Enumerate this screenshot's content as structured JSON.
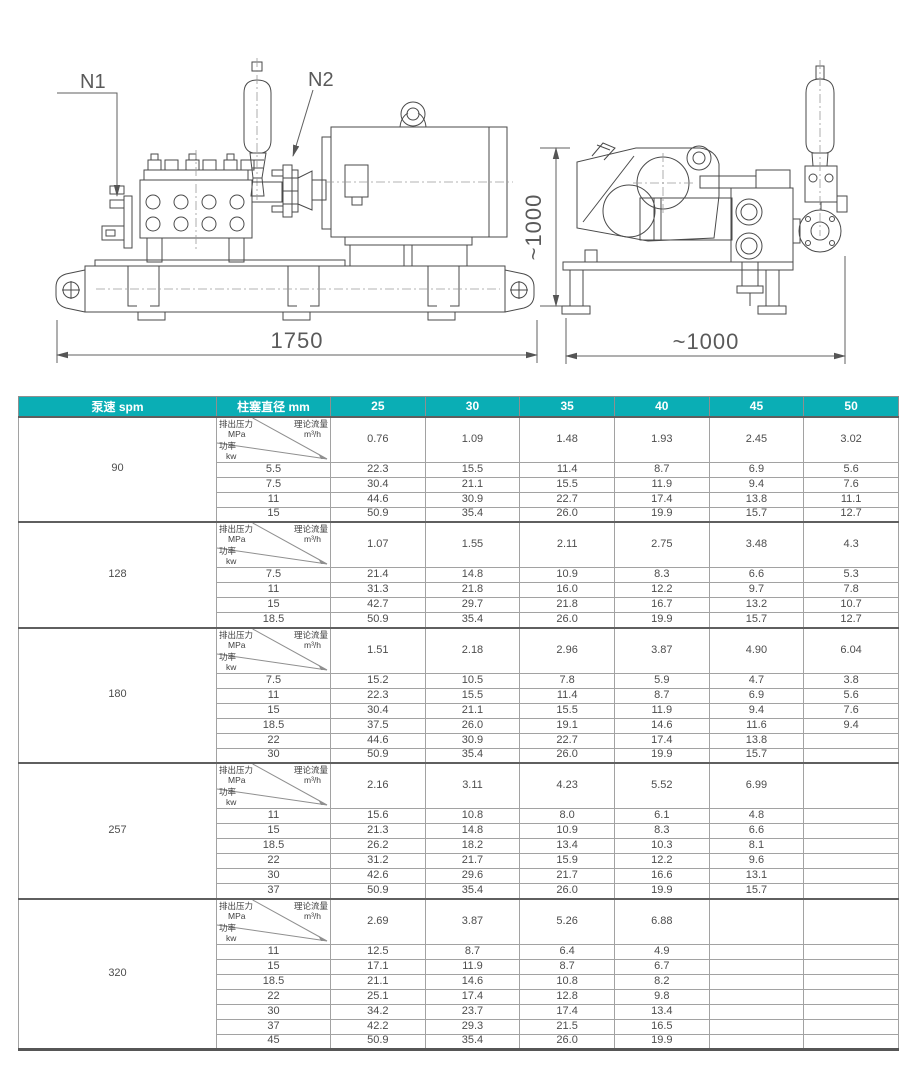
{
  "drawing": {
    "labels": {
      "n1": "N1",
      "n2": "N2",
      "dim_length": "1750",
      "dim_height": "~1000",
      "dim_width": "~1000"
    },
    "line_color": "#4a4a4a",
    "dim_color": "#5a5a5a"
  },
  "table": {
    "accent_color": "#0aaeb5",
    "header": {
      "speed": "泵速  spm",
      "diameter": "柱塞直径 mm"
    },
    "diameters": [
      "25",
      "30",
      "35",
      "40",
      "45",
      "50"
    ],
    "diag": {
      "pressure": "排出压力",
      "pressure_unit": "MPa",
      "flow": "理论流量",
      "flow_unit": "m³/h",
      "power": "功率",
      "power_unit": "kw"
    },
    "sections": [
      {
        "speed": "90",
        "flow": [
          "0.76",
          "1.09",
          "1.48",
          "1.93",
          "2.45",
          "3.02"
        ],
        "rows": [
          {
            "power": "5.5",
            "values": [
              "22.3",
              "15.5",
              "11.4",
              "8.7",
              "6.9",
              "5.6"
            ]
          },
          {
            "power": "7.5",
            "values": [
              "30.4",
              "21.1",
              "15.5",
              "11.9",
              "9.4",
              "7.6"
            ]
          },
          {
            "power": "11",
            "values": [
              "44.6",
              "30.9",
              "22.7",
              "17.4",
              "13.8",
              "11.1"
            ]
          },
          {
            "power": "15",
            "values": [
              "50.9",
              "35.4",
              "26.0",
              "19.9",
              "15.7",
              "12.7"
            ]
          }
        ]
      },
      {
        "speed": "128",
        "flow": [
          "1.07",
          "1.55",
          "2.11",
          "2.75",
          "3.48",
          "4.3"
        ],
        "rows": [
          {
            "power": "7.5",
            "values": [
              "21.4",
              "14.8",
              "10.9",
              "8.3",
              "6.6",
              "5.3"
            ]
          },
          {
            "power": "11",
            "values": [
              "31.3",
              "21.8",
              "16.0",
              "12.2",
              "9.7",
              "7.8"
            ]
          },
          {
            "power": "15",
            "values": [
              "42.7",
              "29.7",
              "21.8",
              "16.7",
              "13.2",
              "10.7"
            ]
          },
          {
            "power": "18.5",
            "values": [
              "50.9",
              "35.4",
              "26.0",
              "19.9",
              "15.7",
              "12.7"
            ]
          }
        ]
      },
      {
        "speed": "180",
        "flow": [
          "1.51",
          "2.18",
          "2.96",
          "3.87",
          "4.90",
          "6.04"
        ],
        "rows": [
          {
            "power": "7.5",
            "values": [
              "15.2",
              "10.5",
              "7.8",
              "5.9",
              "4.7",
              "3.8"
            ]
          },
          {
            "power": "11",
            "values": [
              "22.3",
              "15.5",
              "11.4",
              "8.7",
              "6.9",
              "5.6"
            ]
          },
          {
            "power": "15",
            "values": [
              "30.4",
              "21.1",
              "15.5",
              "11.9",
              "9.4",
              "7.6"
            ]
          },
          {
            "power": "18.5",
            "values": [
              "37.5",
              "26.0",
              "19.1",
              "14.6",
              "11.6",
              "9.4"
            ]
          },
          {
            "power": "22",
            "values": [
              "44.6",
              "30.9",
              "22.7",
              "17.4",
              "13.8",
              ""
            ]
          },
          {
            "power": "30",
            "values": [
              "50.9",
              "35.4",
              "26.0",
              "19.9",
              "15.7",
              ""
            ]
          }
        ]
      },
      {
        "speed": "257",
        "flow": [
          "2.16",
          "3.11",
          "4.23",
          "5.52",
          "6.99",
          ""
        ],
        "rows": [
          {
            "power": "11",
            "values": [
              "15.6",
              "10.8",
              "8.0",
              "6.1",
              "4.8",
              ""
            ]
          },
          {
            "power": "15",
            "values": [
              "21.3",
              "14.8",
              "10.9",
              "8.3",
              "6.6",
              ""
            ]
          },
          {
            "power": "18.5",
            "values": [
              "26.2",
              "18.2",
              "13.4",
              "10.3",
              "8.1",
              ""
            ]
          },
          {
            "power": "22",
            "values": [
              "31.2",
              "21.7",
              "15.9",
              "12.2",
              "9.6",
              ""
            ]
          },
          {
            "power": "30",
            "values": [
              "42.6",
              "29.6",
              "21.7",
              "16.6",
              "13.1",
              ""
            ]
          },
          {
            "power": "37",
            "values": [
              "50.9",
              "35.4",
              "26.0",
              "19.9",
              "15.7",
              ""
            ]
          }
        ]
      },
      {
        "speed": "320",
        "flow": [
          "2.69",
          "3.87",
          "5.26",
          "6.88",
          "",
          ""
        ],
        "rows": [
          {
            "power": "11",
            "values": [
              "12.5",
              "8.7",
              "6.4",
              "4.9",
              "",
              ""
            ]
          },
          {
            "power": "15",
            "values": [
              "17.1",
              "11.9",
              "8.7",
              "6.7",
              "",
              ""
            ]
          },
          {
            "power": "18.5",
            "values": [
              "21.1",
              "14.6",
              "10.8",
              "8.2",
              "",
              ""
            ]
          },
          {
            "power": "22",
            "values": [
              "25.1",
              "17.4",
              "12.8",
              "9.8",
              "",
              ""
            ]
          },
          {
            "power": "30",
            "values": [
              "34.2",
              "23.7",
              "17.4",
              "13.4",
              "",
              ""
            ]
          },
          {
            "power": "37",
            "values": [
              "42.2",
              "29.3",
              "21.5",
              "16.5",
              "",
              ""
            ]
          },
          {
            "power": "45",
            "values": [
              "50.9",
              "35.4",
              "26.0",
              "19.9",
              "",
              ""
            ]
          }
        ]
      }
    ]
  }
}
